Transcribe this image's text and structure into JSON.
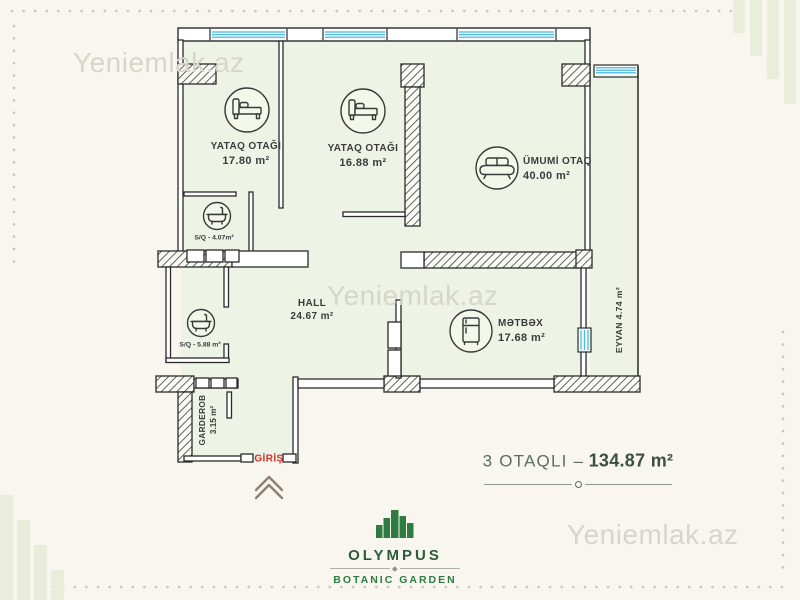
{
  "watermark": "Yeniemlak.az",
  "plan": {
    "bedroom1": {
      "name": "YATAQ OTAĞI",
      "area": "17.80 m²"
    },
    "bedroom2": {
      "name": "YATAQ OTAĞI",
      "area": "16.88 m²"
    },
    "living": {
      "name": "ÜMUMİ OTAQ",
      "area": "40.00 m²"
    },
    "bath1": {
      "name": "S/Q - 4.07m²"
    },
    "bath2": {
      "name": "S/Q - 5.88 m²"
    },
    "hall": {
      "name": "HALL",
      "area": "24.67 m²"
    },
    "kitchen": {
      "name": "MƏTBƏX",
      "area": "17.68 m²"
    },
    "balcony": {
      "name": "EYVAN 4.74 m²"
    },
    "garderob": {
      "name": "GARDEROB",
      "area": "3.15 m²"
    },
    "entrance": {
      "name": "GİRİŞ"
    }
  },
  "summary": {
    "rooms_label": "3 OTAQLI –",
    "area": "134.87 m²"
  },
  "branding": {
    "name": "OLYMPUS",
    "tagline": "BOTANIC GARDEN"
  },
  "colors": {
    "background": "#f8f6ef",
    "room_fill": "#edf3e5",
    "wall": "#2b2b2b",
    "window_blue": "#52bbe3",
    "entrance_red": "#d3302c",
    "brand_green": "#2e7c42",
    "watermark_gray": "#d8d5ca"
  }
}
